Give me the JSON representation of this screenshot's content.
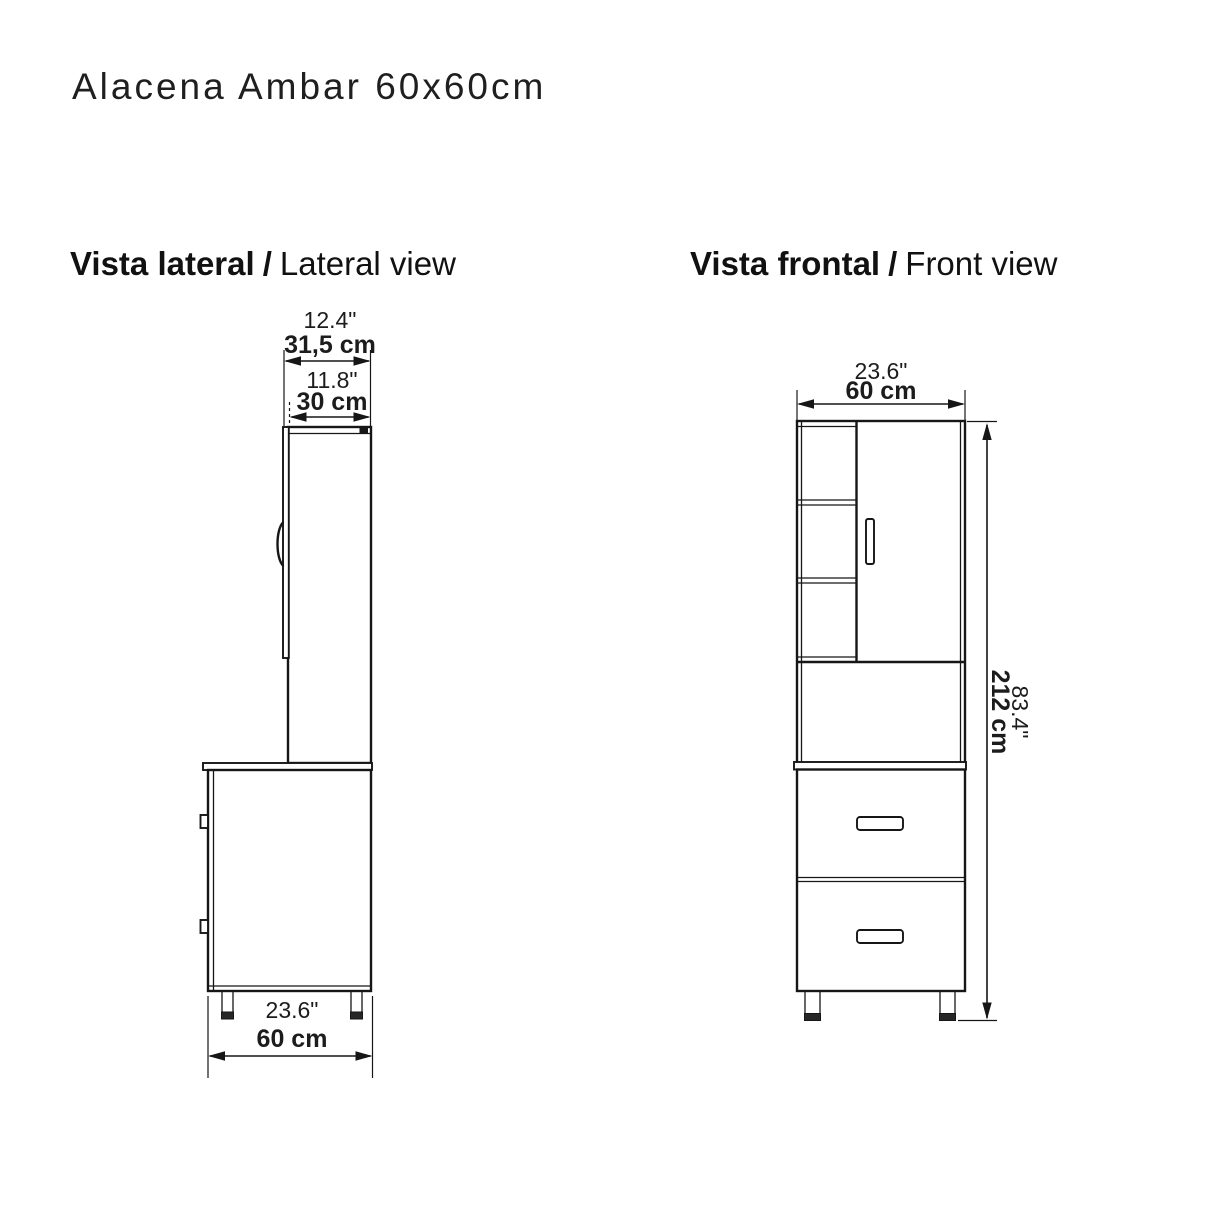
{
  "title": "Alacena Ambar 60x60cm",
  "colors": {
    "line": "#161616",
    "text": "#1c1c1c",
    "background": "#ffffff"
  },
  "lateral": {
    "heading_es": "Vista lateral",
    "heading_sep": "/",
    "heading_en": "Lateral view",
    "dims": {
      "total_depth_in": "12.4\"",
      "total_depth_cm": "31,5 cm",
      "body_depth_in": "11.8\"",
      "body_depth_cm": "30 cm",
      "base_width_in": "23.6\"",
      "base_width_cm": "60 cm"
    }
  },
  "frontal": {
    "heading_es": "Vista frontal",
    "heading_sep": "/",
    "heading_en": "Front view",
    "dims": {
      "width_in": "23.6\"",
      "width_cm": "60 cm",
      "height_in": "83.4\"",
      "height_cm": "212 cm"
    }
  }
}
